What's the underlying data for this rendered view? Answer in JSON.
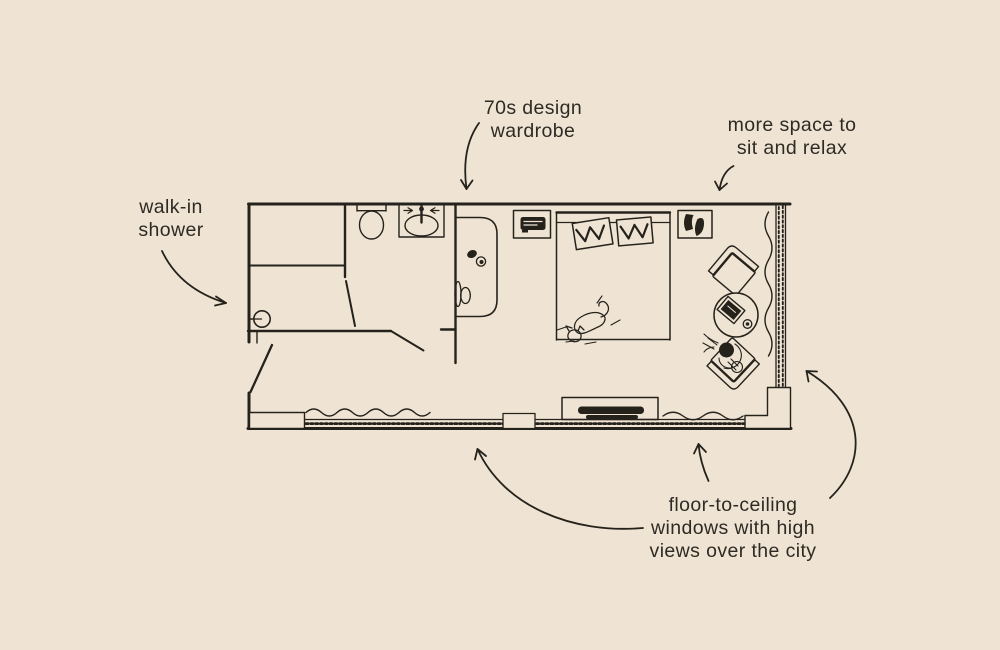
{
  "page": {
    "background_color": "#efe4d3",
    "ink_color": "#25221c",
    "text_color": "#2e2a24"
  },
  "annotations": {
    "walk_in_shower": {
      "label": "walk-in\nshower"
    },
    "wardrobe": {
      "label": "70s design\nwardrobe"
    },
    "sitting_area": {
      "label": "more space to\nsit and relax"
    },
    "windows": {
      "label": "floor-to-ceiling\nwindows with high\nviews over the city"
    }
  },
  "floorplan": {
    "icon_names": [
      "shower-head-icon",
      "toilet-icon",
      "sink-icon",
      "bathroom-door",
      "entry-door",
      "wardrobe-70s",
      "wardrobe-handle",
      "wardrobe-shoes",
      "nightstand-left",
      "radio-icon",
      "nightstand-right",
      "bag-icon",
      "bed",
      "pillow",
      "pillow",
      "cat-sleeping",
      "tv-console",
      "tv-icon",
      "armchair-top",
      "armchair-bottom",
      "person-sitting",
      "round-table",
      "laptop-icon",
      "cup-icon",
      "curtain-wave-bottom-left",
      "curtain-wave-bottom-right",
      "curtain-wave-right",
      "window-band-bottom",
      "window-band-right",
      "window-mullion",
      "wall-pier-left",
      "wall-pier-right"
    ]
  }
}
